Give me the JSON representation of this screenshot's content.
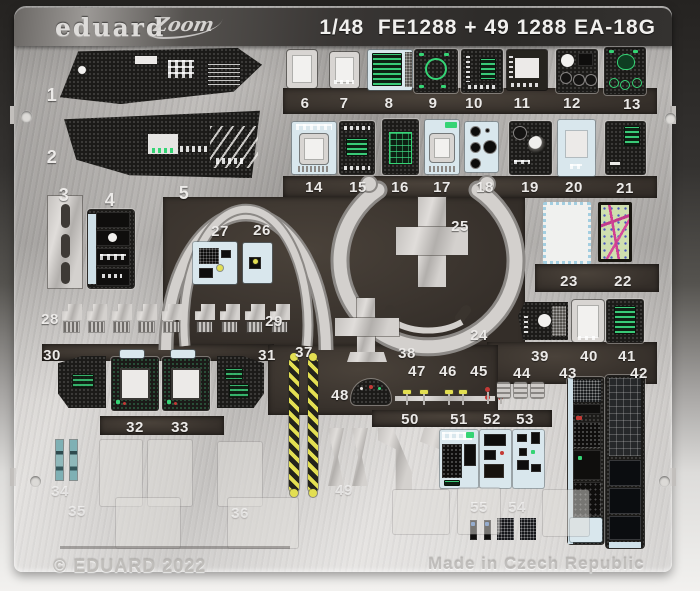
{
  "header": {
    "brand_logo": "eduard",
    "sub_logo": "Zoom",
    "title": "1/48  FE1288 + 49 1288 EA-18G",
    "scale": "1/48",
    "product_codes": [
      "FE1288",
      "49 1288"
    ],
    "aircraft": "EA-18G"
  },
  "footer": {
    "copyright": "© EDUARD 2022",
    "made_in": "Made in Czech Republic"
  },
  "palette": {
    "metal_light": "#d6d3d0",
    "metal_mid": "#b2afac",
    "band_dark": "#2c2a28",
    "cutout_dark": "#342e29",
    "part_black": "#1b1a18",
    "display_green": "#35d475",
    "placard_blue": "#d9e7ed",
    "stripe_yellow": "#e3df52",
    "handle_red": "#c43a36",
    "map_green": "#cfdfae",
    "map_magenta": "#cf3f93",
    "text_etched": "#eceae8"
  },
  "parts": [
    {
      "number": "1"
    },
    {
      "number": "2"
    },
    {
      "number": "3"
    },
    {
      "number": "4"
    },
    {
      "number": "5"
    },
    {
      "number": "6"
    },
    {
      "number": "7"
    },
    {
      "number": "8"
    },
    {
      "number": "9"
    },
    {
      "number": "10"
    },
    {
      "number": "11"
    },
    {
      "number": "12"
    },
    {
      "number": "13"
    },
    {
      "number": "14"
    },
    {
      "number": "15"
    },
    {
      "number": "16"
    },
    {
      "number": "17"
    },
    {
      "number": "18"
    },
    {
      "number": "19"
    },
    {
      "number": "20"
    },
    {
      "number": "21"
    },
    {
      "number": "22"
    },
    {
      "number": "23"
    },
    {
      "number": "24"
    },
    {
      "number": "25"
    },
    {
      "number": "26"
    },
    {
      "number": "27"
    },
    {
      "number": "28"
    },
    {
      "number": "29"
    },
    {
      "number": "30"
    },
    {
      "number": "31"
    },
    {
      "number": "32"
    },
    {
      "number": "33"
    },
    {
      "number": "34"
    },
    {
      "number": "35"
    },
    {
      "number": "36"
    },
    {
      "number": "37"
    },
    {
      "number": "38"
    },
    {
      "number": "39"
    },
    {
      "number": "40"
    },
    {
      "number": "41"
    },
    {
      "number": "42"
    },
    {
      "number": "43"
    },
    {
      "number": "44"
    },
    {
      "number": "45"
    },
    {
      "number": "46"
    },
    {
      "number": "47"
    },
    {
      "number": "48"
    },
    {
      "number": "49"
    },
    {
      "number": "50"
    },
    {
      "number": "51"
    },
    {
      "number": "52"
    },
    {
      "number": "53"
    },
    {
      "number": "54"
    },
    {
      "number": "55"
    }
  ]
}
